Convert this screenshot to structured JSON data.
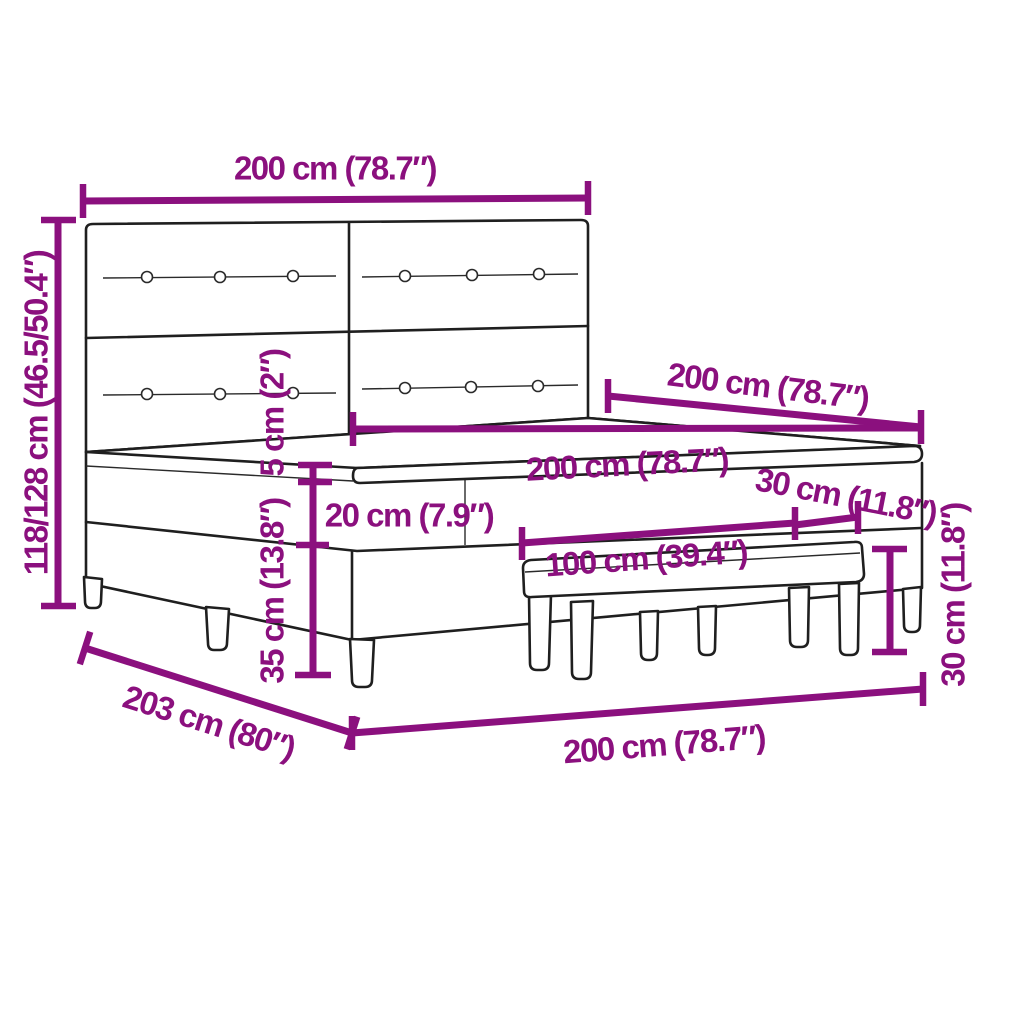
{
  "meta": {
    "type": "product dimension diagram",
    "product": "box spring bed with tufted headboard and bench"
  },
  "colors": {
    "background": "#ffffff",
    "dimension_accent": "#8B107E",
    "outline": "#1f1f1f"
  },
  "dimensions": {
    "headboard_width": {
      "label": "200 cm (78.7″)",
      "value_cm": "200"
    },
    "total_height": {
      "label": "118/128 cm (46.5/50.4″)",
      "value_cm": "118/128"
    },
    "bed_length": {
      "label": "200 cm (78.7″)",
      "value_cm": "200"
    },
    "mattress_width": {
      "label": "200 cm (78.7″)",
      "value_cm": "200"
    },
    "topper_height": {
      "label": "5 cm (2″)",
      "value_cm": "5"
    },
    "mattress_height": {
      "label": "20 cm (7.9″)",
      "value_cm": "20"
    },
    "base_height": {
      "label": "35 cm (13.8″)",
      "value_cm": "35"
    },
    "bench_length": {
      "label": "100 cm (39.4″)",
      "value_cm": "100"
    },
    "bench_depth": {
      "label": "30 cm (11.8″)",
      "value_cm": "30"
    },
    "bench_height": {
      "label": "30 cm (11.8″)",
      "value_cm": "30"
    },
    "floor_width": {
      "label": "200 cm (78.7″)",
      "value_cm": "200"
    },
    "floor_length": {
      "label": "203 cm (80″)",
      "value_cm": "203"
    }
  }
}
